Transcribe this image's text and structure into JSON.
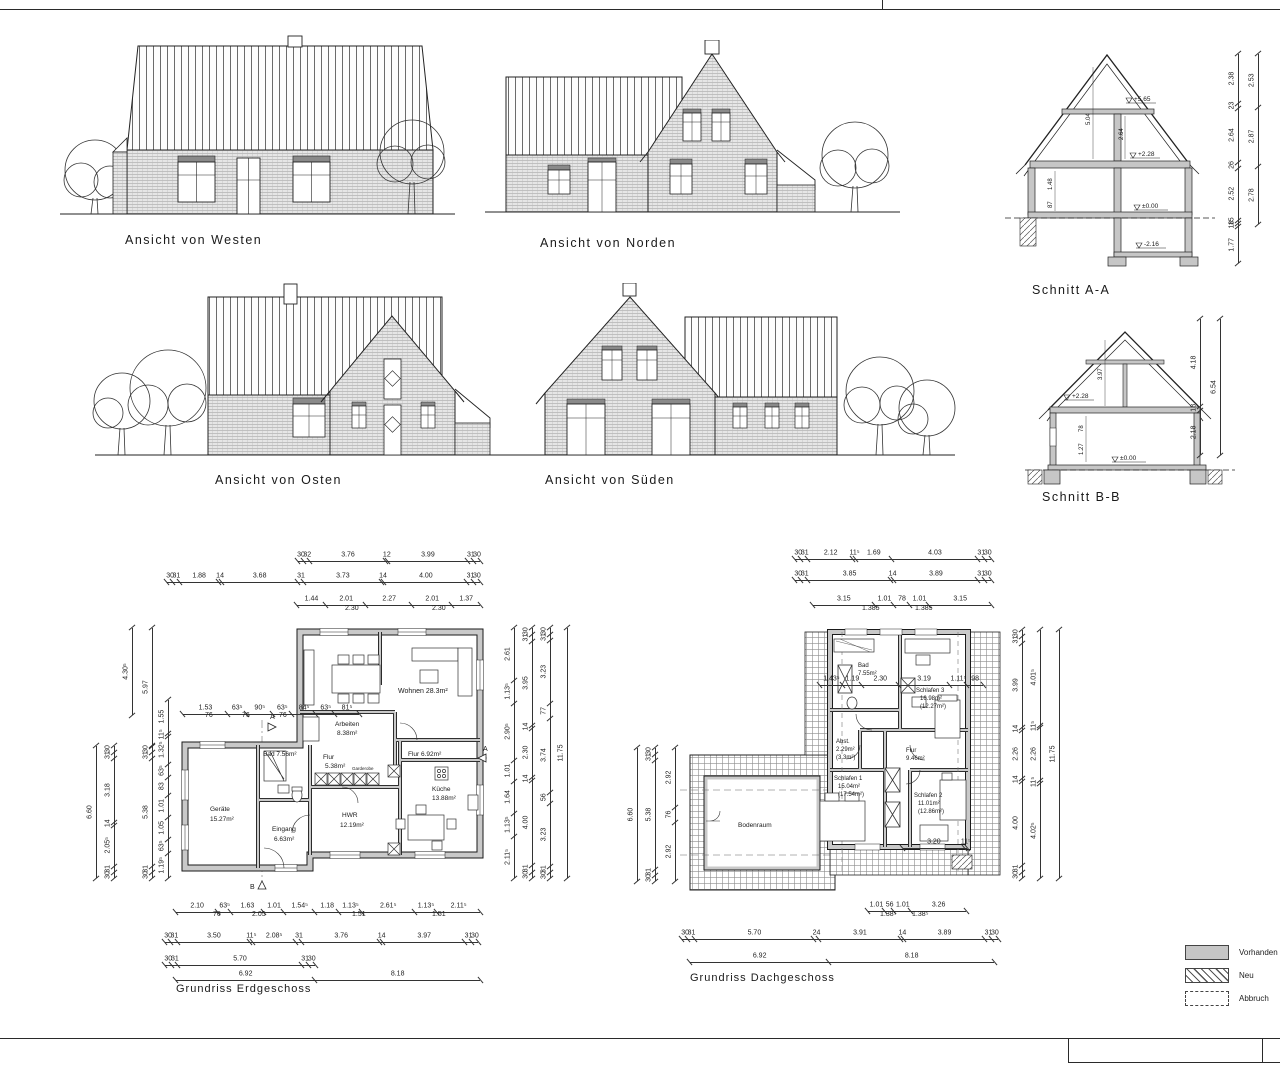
{
  "elevations": {
    "west": {
      "label": "Ansicht von Westen"
    },
    "north": {
      "label": "Ansicht von Norden"
    },
    "east": {
      "label": "Ansicht von Osten"
    },
    "south": {
      "label": "Ansicht von Süden"
    }
  },
  "sections": {
    "aa": {
      "label": "Schnitt A-A",
      "levels": {
        "ridge": "+5.65",
        "upper": "+2.28",
        "ground": "±0.00",
        "basement": "-2.16"
      },
      "internal_dims": [
        "5.04",
        "2.64",
        "1.48",
        "87"
      ],
      "chain_inner": [
        "2.38",
        "23",
        "2.64",
        "26",
        "2.52",
        "15",
        "18",
        "1.77"
      ],
      "chain_outer": [
        "2.53",
        "2.87",
        "2.78"
      ]
    },
    "bb": {
      "label": "Schnitt B-B",
      "levels": {
        "upper": "+2.28",
        "ground": "±0.00"
      },
      "internal_dims": [
        "3.97",
        "78",
        "1.27"
      ],
      "chain_inner": [
        "4.18",
        "18",
        "2.18"
      ],
      "chain_outer": [
        "6.54"
      ]
    }
  },
  "floorplans": {
    "eg": {
      "label": "Grundriss Erdgeschoss",
      "markers": {
        "a": "A",
        "b": "B"
      },
      "rooms": {
        "wohnen": [
          "Wohnen 28.3m²"
        ],
        "arbeiten": [
          "Arbeiten",
          "8.38m²"
        ],
        "flur_gross": [
          "Flur 6.92m²"
        ],
        "flur_klein": [
          "Flur",
          "5.38m²"
        ],
        "bad": [
          "Bad 7.56m²"
        ],
        "geraete": [
          "Geräte",
          "15.27m²"
        ],
        "eingang": [
          "Eingang",
          "6.63m²"
        ],
        "hwr": [
          "HWR",
          "12.19m²"
        ],
        "kueche": [
          "Küche",
          "13.88m²"
        ],
        "garderobe": [
          "Garderobe"
        ]
      },
      "chains": {
        "top1": [
          "30",
          "32",
          "3.76",
          "12",
          "3.99",
          "31",
          "30"
        ],
        "top2": [
          "30",
          "31",
          "1.88",
          "14",
          "3.68",
          "31",
          "3.73",
          "14",
          "4.00",
          "31",
          "30"
        ],
        "top3": [
          "1.44",
          "2.01",
          "2.27",
          "2.01",
          "1.37"
        ],
        "top3_sub": [
          "2.30",
          "2.30"
        ],
        "inner": [
          "1.53",
          "63⁵",
          "90⁵",
          "63⁵",
          "84⁵",
          "63⁵",
          "81⁵"
        ],
        "inner_sub": [
          "76",
          "76",
          "76"
        ],
        "bottom1": [
          "2.10",
          "63⁵",
          "1.63",
          "1.01",
          "1.54⁵",
          "1.18",
          "1.13⁵",
          "2.61⁵",
          "1.13⁵",
          "2.11⁵"
        ],
        "bottom1_sub": [
          "76",
          "2.05",
          "1.51",
          "1.51"
        ],
        "bottom2": [
          "30",
          "31",
          "3.50",
          "11⁵",
          "2.08⁵",
          "31",
          "3.76",
          "14",
          "3.97",
          "31",
          "30"
        ],
        "bottom3": [
          "30",
          "31",
          "5.70",
          "31",
          "30"
        ],
        "bottom4": [
          "6.92",
          "8.18"
        ],
        "left1": [
          "6.60"
        ],
        "left2": [
          "30",
          "31",
          "3.18",
          "14",
          "2.05⁵",
          "31",
          "30"
        ],
        "left3": [
          "30",
          "31",
          "5.38",
          "31",
          "30"
        ],
        "left3b": [
          "5.97"
        ],
        "left4": [
          "4.30⁵"
        ],
        "left_detail": [
          "1.55",
          "11⁵",
          "1.32⁵",
          "63⁵",
          "83",
          "1.01",
          "1.05",
          "63⁵",
          "1.19⁵"
        ],
        "left_detail_sub": [
          "1.51",
          "76",
          "2.05",
          "76"
        ],
        "right_detail": [
          "2.61",
          "1.13⁵",
          "2.90⁵",
          "1.01",
          "1.64",
          "1.13⁵",
          "2.11⁵"
        ],
        "right_detail_sub": [
          "1.51",
          "2.30",
          "1.51"
        ],
        "right2": [
          "30",
          "31",
          "3.95",
          "14",
          "2.30",
          "14",
          "4.00",
          "31",
          "30"
        ],
        "right3": [
          "30",
          "31",
          "3.23",
          "77",
          "3.74",
          "56",
          "3.23",
          "31",
          "30"
        ],
        "right4": [
          "11.75"
        ]
      }
    },
    "og": {
      "label": "Grundriss Dachgeschoss",
      "rooms": {
        "bodenraum": [
          "Bodenraum"
        ],
        "bad": [
          "Bad",
          "7.55m²"
        ],
        "schlafen3": [
          "Schlafen 3",
          "16.98m²",
          "(12.27m²)"
        ],
        "schlafen1": [
          "Schlafen 1",
          "15.04m²",
          "(17.54m²)"
        ],
        "schlafen2": [
          "Schlafen 2",
          "11.01m²",
          "(12.86m²)"
        ],
        "abst": [
          "Abst.",
          "2.29m²",
          "(3.3m²)"
        ],
        "flur": [
          "Flur",
          "9.46m²"
        ]
      },
      "chains": {
        "top1": [
          "30",
          "31",
          "2.12",
          "11⁵",
          "1.69",
          "4.03",
          "31",
          "30"
        ],
        "top2": [
          "30",
          "31",
          "3.85",
          "14",
          "3.89",
          "31",
          "30"
        ],
        "top3": [
          "3.15",
          "1.01",
          "78",
          "1.01",
          "3.15"
        ],
        "top3_sub": [
          "1.385",
          "1.385"
        ],
        "inner": [
          "1.43⁵",
          "1.19",
          "2.30",
          "3.19",
          "1.11⁵",
          "98"
        ],
        "inner2": [
          "3.20",
          "11⁵"
        ],
        "bottom1": [
          "1.01",
          "56",
          "1.01",
          "3.26"
        ],
        "bottom1_sub": [
          "1.38⁵",
          "1.38⁵"
        ],
        "bottom2": [
          "30",
          "31",
          "5.70",
          "24",
          "3.91",
          "14",
          "3.89",
          "31",
          "30"
        ],
        "bottom3": [
          "6.92",
          "8.18"
        ],
        "left1": [
          "6.60"
        ],
        "left2": [
          "30",
          "31",
          "5.38",
          "31",
          "30"
        ],
        "left3": [
          "2.92",
          "76",
          "2.92"
        ],
        "left3_sub": [
          "1.63⁵"
        ],
        "right1": [
          "30",
          "31",
          "3.99",
          "14",
          "2.26",
          "14",
          "4.00",
          "31",
          "30"
        ],
        "right2": [
          "4.01⁵",
          "11⁵",
          "2.26",
          "11⁵",
          "4.02⁵"
        ],
        "right3": [
          "11.75"
        ]
      }
    }
  },
  "legend": {
    "items": [
      {
        "label": "Vorhanden",
        "swatch": "solid"
      },
      {
        "label": "Neu",
        "swatch": "hatch"
      },
      {
        "label": "Abbruch",
        "swatch": "dashed"
      }
    ]
  },
  "colors": {
    "existing_fill": "#c6c6c6",
    "line": "#1a1a1a"
  }
}
